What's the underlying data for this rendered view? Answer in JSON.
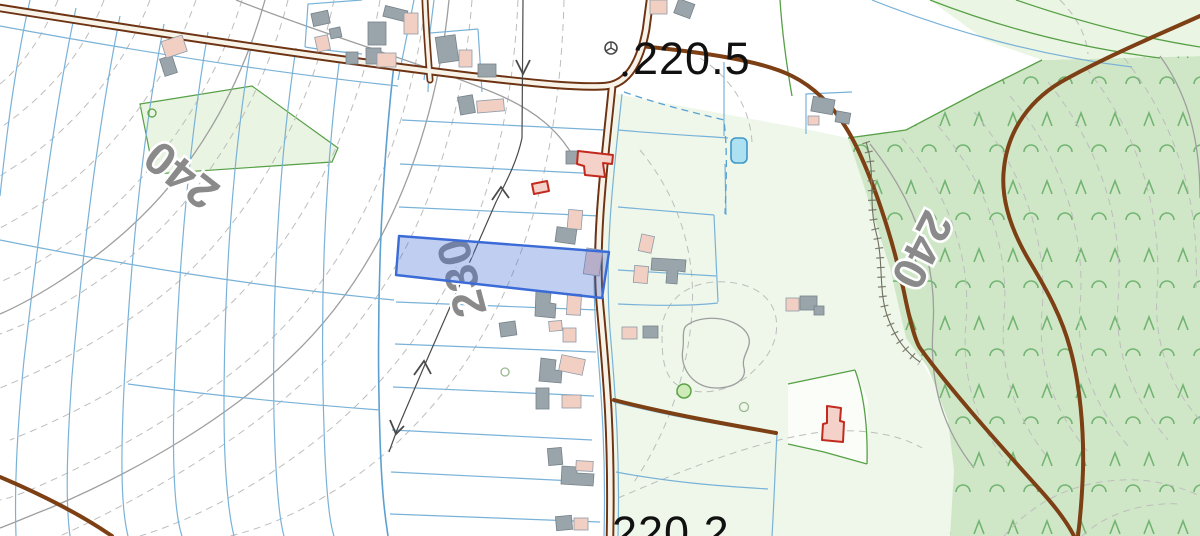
{
  "map": {
    "labels": {
      "spot_elevation_top": "220.5",
      "spot_elevation_bottom": "220.2",
      "contour_west": "240",
      "contour_center": "230",
      "contour_east": "240"
    },
    "colors": {
      "road_brown": "#7d3f14",
      "road_casing_brown": "#6e3312",
      "road_fill_cream": "#f8f3e9",
      "parcel_line_blue": "#79b2d8",
      "selected_parcel_stroke": "#3a6bd6",
      "selected_parcel_fill": "rgba(70,115,215,0.34)",
      "contour_dashed_gray": "#bdbdbd",
      "contour_index_gray": "#9e9e9e",
      "forest_green": "#d0e7c7",
      "meadow_green": "#eef7ea",
      "tree_symbol_green": "#72b472",
      "boundary_green": "#56a046",
      "building_gray": "#9aa5ab",
      "building_pink": "#f2cfc3",
      "selected_building_red": "#c22a1e",
      "water_blue": "#ade0f0",
      "water_outline": "#3e97c8",
      "elevation_label_gray": "#8a8a8a",
      "elevation_label_black": "#111111"
    },
    "icons": {
      "survey_marker": "circle-with-three-spokes",
      "spot_height": "black-dot",
      "conifer_tree": "caret-up-glyph",
      "deciduous_tree": "open-arc-glyph",
      "slope_arrow": "chevron-arrowhead"
    }
  }
}
